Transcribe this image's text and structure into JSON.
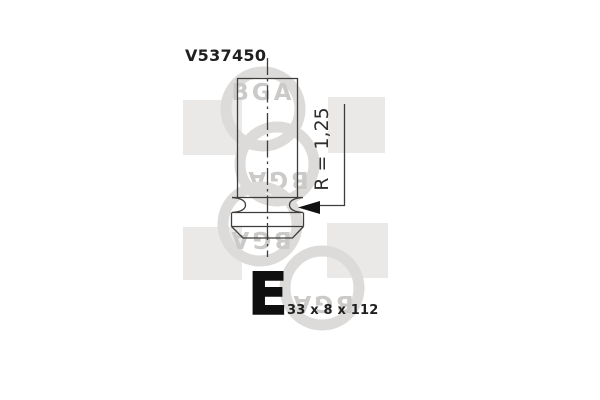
{
  "part": {
    "number": "V537450",
    "category_letter": "E",
    "size_label": "33 x 8 x 112",
    "radius_label": "R = 1,25"
  },
  "watermark": {
    "brand": "BGA"
  },
  "colors": {
    "background": "#ffffff",
    "drawing_line": "#3d3d3d",
    "text": "#1f1f1f",
    "watermark_square": "#eae9e7",
    "watermark_ring": "#dcdbd9",
    "watermark_text": "#cbcac8"
  }
}
